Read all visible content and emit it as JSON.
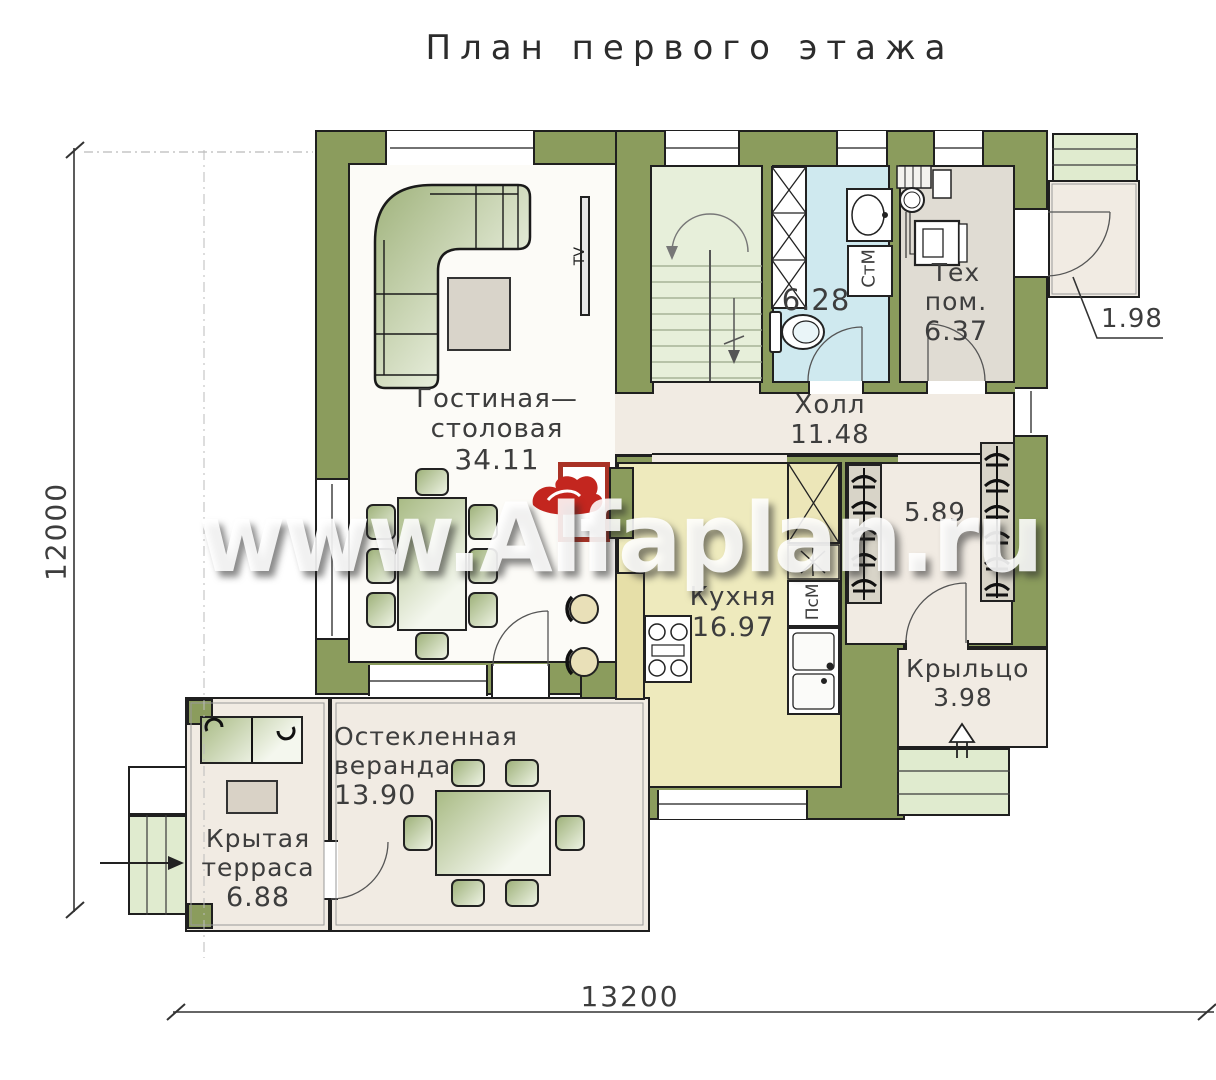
{
  "title": "План первого этажа",
  "watermark": "www.Alfaplan.ru",
  "dimensions": {
    "bottom": "13200",
    "left": "12000"
  },
  "rooms": {
    "living": {
      "line1": "Гостиная—",
      "line2": "столовая",
      "area": "34.11"
    },
    "hall": {
      "name": "Холл",
      "area": "11.48"
    },
    "kitchen": {
      "name": "Кухня",
      "area": "16.97"
    },
    "bathroom": {
      "area": "6.28"
    },
    "tech": {
      "name": "Тех пом.",
      "area": "6.37"
    },
    "entry": {
      "area": "5.89"
    },
    "porch": {
      "name": "Крыльцо",
      "area": "3.98"
    },
    "veranda": {
      "line1": "Остекленная",
      "line2": "веранда",
      "area": "13.90"
    },
    "terrace": {
      "line1": "Крытая",
      "line2": "терраса",
      "area": "6.88"
    },
    "back_porch": {
      "area": "1.98"
    }
  },
  "appliances": {
    "washing_machine": "СтМ",
    "dishwasher": "ПсМ",
    "tv": "TV"
  },
  "colors": {
    "wall": "#8b9c5d",
    "floor_living": "#fcfbf7",
    "floor_kitchen": "#eeeabd",
    "floor_bath": "#cfe9ef",
    "floor_stairs": "#e7efda",
    "floor_tech": "#e0dcd3",
    "floor_beige": "#f1ebe3",
    "steps": "#e0ebcf",
    "fireplace_red": "#a93226"
  }
}
